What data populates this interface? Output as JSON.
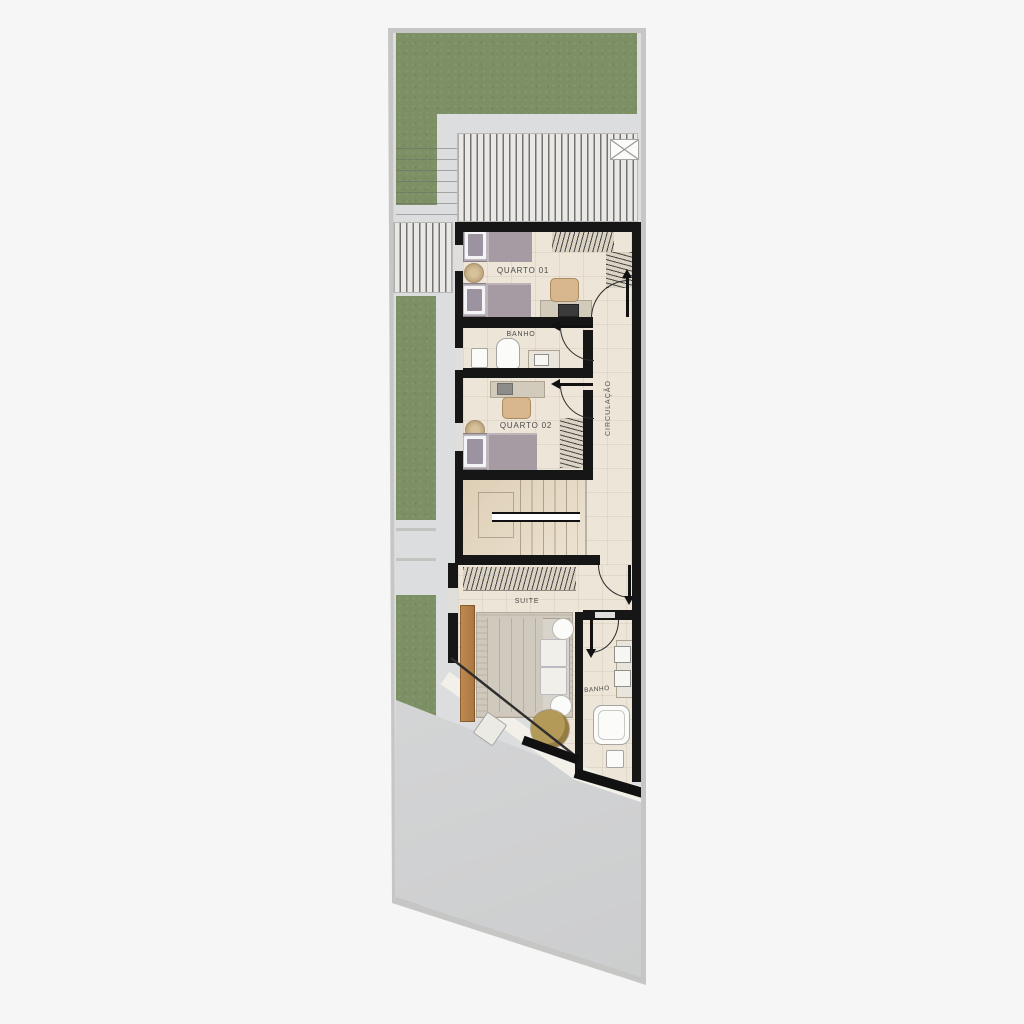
{
  "plan": {
    "title": "residential-upper-floor-plan",
    "rooms": [
      {
        "id": "quarto-01",
        "label": "QUARTO 01"
      },
      {
        "id": "banho-superior",
        "label": "BANHO"
      },
      {
        "id": "quarto-02",
        "label": "QUARTO 02"
      },
      {
        "id": "circulacao",
        "label": "CIRCULAÇÃO"
      },
      {
        "id": "suite",
        "label": "SUITE"
      },
      {
        "id": "banho-suite",
        "label": "BANHO"
      }
    ],
    "palette": {
      "background": "#f6f6f6",
      "lot_wall": "#c6c6c5",
      "paving": "#dcddde",
      "slab": "#d7d8d9",
      "grass": "#7d9065",
      "interior_wall": "#161616",
      "floor_tile": "#ece5d8",
      "stair_stone": "#e7dbc5",
      "wood_panel": "#bf8a52",
      "bed_fabric": "#a79ba3",
      "suite_bedding": "#d9d4cb",
      "armchair": "#b49a58",
      "label_text": "#4b4b49"
    }
  }
}
